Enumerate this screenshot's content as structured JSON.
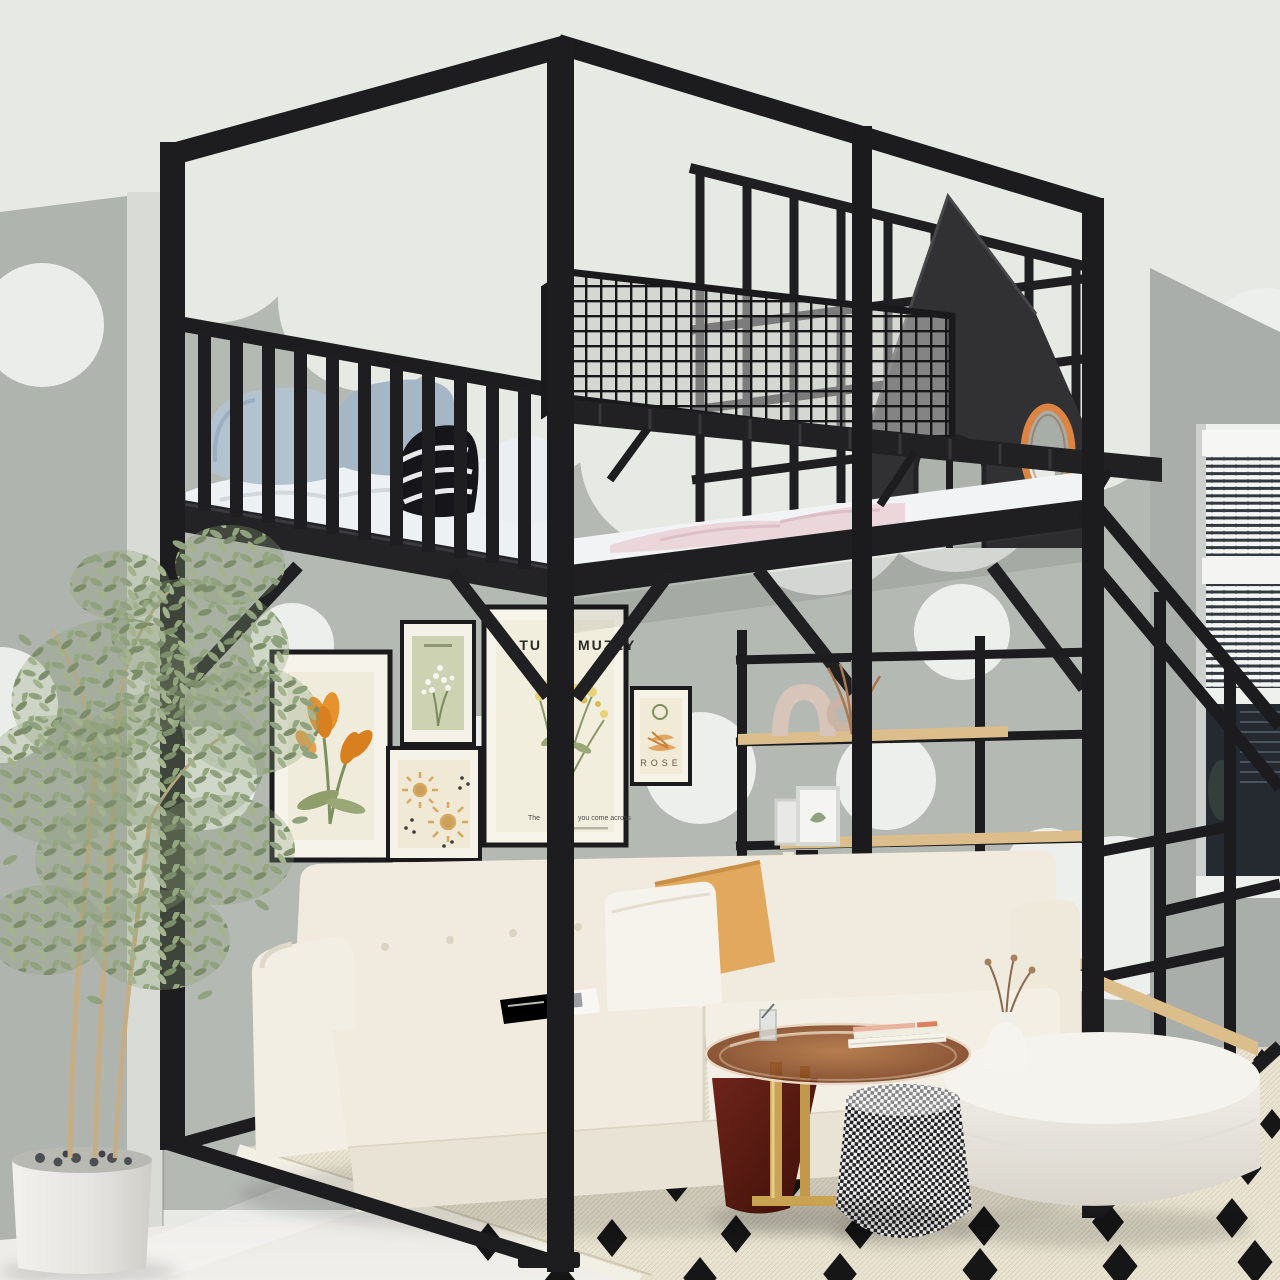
{
  "photo": {
    "description": "Black metal loft bed with house-shaped headboard over a cream sofa, gallery wall posters, bookshelf-stair frame, polka dot walls, patterned rug and plants"
  },
  "posters": {
    "muzzy": {
      "title_left": "TU",
      "title_right": "MUZZY",
      "caption_left": "The",
      "caption_right": "you come across"
    },
    "rose": {
      "title": "ROSE"
    }
  },
  "bookshelf": {
    "book_spine": "CHANEL"
  },
  "palette": {
    "frame_black": "#1d1d20",
    "porthole_orange": "#dd8443",
    "shelf_wood": "#dcbd8c",
    "sofa_cream": "#f1ebdf",
    "accent_pillow": "#e2a95e",
    "rug_cream": "#eae5d3",
    "wall_gray": "#b5b9b4"
  }
}
